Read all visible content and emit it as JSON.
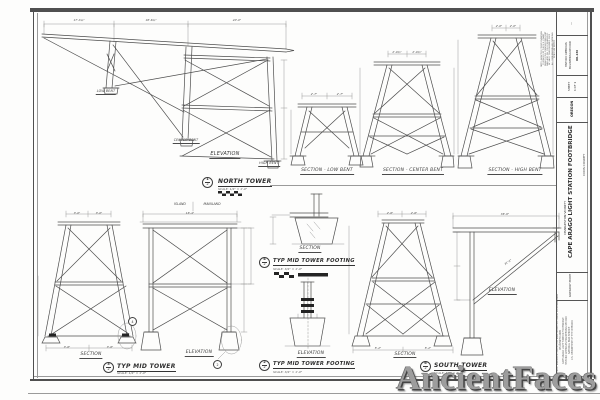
{
  "watermark": "AncientFaces",
  "labels": {
    "elevation": "ELEVATION",
    "section": "SECTION",
    "low_bent": "LOW BENT",
    "center_bent": "CENTER BENT",
    "high_bent": "HIGH BENT",
    "section_low_bent": "SECTION - LOW BENT",
    "section_center_bent": "SECTION - CENTER BENT",
    "section_high_bent": "SECTION - HIGH BENT",
    "island": "ISLAND",
    "mainland": "MAINLAND"
  },
  "titles": {
    "north_tower": {
      "num": "1",
      "den": "2",
      "label": "NORTH TOWER",
      "scale": "SCALE: 1/4\" = 1'-0\""
    },
    "typ_mid_tower": {
      "num": "3",
      "den": "2",
      "label": "TYP MID TOWER",
      "scale": "SCALE: 1/4\" = 1'-0\""
    },
    "footing_section": {
      "num": "4",
      "den": "2",
      "label": "TYP MID TOWER FOOTING",
      "scale": "SCALE: 3/4\" = 1'-0\""
    },
    "footing_elevation": {
      "num": "2",
      "den": "2",
      "label": "TYP MID TOWER FOOTING",
      "scale": "SCALE: 3/4\" = 1'-0\""
    },
    "south_tower": {
      "num": "6",
      "den": "2",
      "label": "SOUTH TOWER",
      "scale": "SCALE: 1/4\" = 1'-0\""
    }
  },
  "dims": {
    "north": [
      "17'-3¼\"",
      "18'-6¾\"",
      "20'-0\""
    ],
    "low": [
      "2'-7\"",
      "2'-7\""
    ],
    "center": [
      "2'-0¾\"",
      "2'-0¾\""
    ],
    "high": [
      "2'-0\"",
      "2'-0\""
    ],
    "mid_top": [
      "3'-0\"",
      "3'-0\""
    ],
    "mid_bottom": [
      "3'-6\"",
      "3'-6\""
    ],
    "mid_elev": [
      "16'-4\""
    ],
    "south_top": [
      "2'-6\"",
      "2'-6\""
    ],
    "south_bottom": [
      "5'-2\"",
      "5'-2\""
    ],
    "south_elev": [
      "36'-6\""
    ],
    "south_diag": [
      "31'-2\""
    ]
  },
  "title_block": {
    "project": "CAPE ARAGO LIGHT STATION FOOTBRIDGE",
    "vicinity": "CHARLESTON VICINITY",
    "county": "COOS COUNTY",
    "locale": "GREGORY POINT",
    "state": "OREGON",
    "sheet_word": "SHEET",
    "sheet_no": "1 OF 1",
    "record_1": "HISTORIC AMERICAN",
    "record_2": "ENGINEERING RECORD",
    "record_no": "OR-136",
    "dash": "—"
  },
  "notes": [
    "NOTE: ADAPTED FROM DRAWINGS",
    "PREPARED BY THE U.S. COAST",
    "GUARD CIVIL ENGINEERING UNIT",
    "OAKLAND CA. FIELD MEASURED",
    "BY HAER TEAM SUMMER 2009",
    "ALL DIMENSIONS ARE NOMINAL",
    "SCALE AS NOTED"
  ],
  "credits": [
    "MEASURED: BRANDON HAUCK, JULY 2009  SURVEYED: DAVID DONOVAN, 2009",
    "DELINEATED 2009",
    "CAPE ARAGO LIGHT STATION FOOTBRIDGE",
    "HISTORIC AMERICAN ENGINEERING RECORD",
    "NATIONAL PARK SERVICE",
    "U.S. DEPARTMENT OF THE INTERIOR"
  ]
}
